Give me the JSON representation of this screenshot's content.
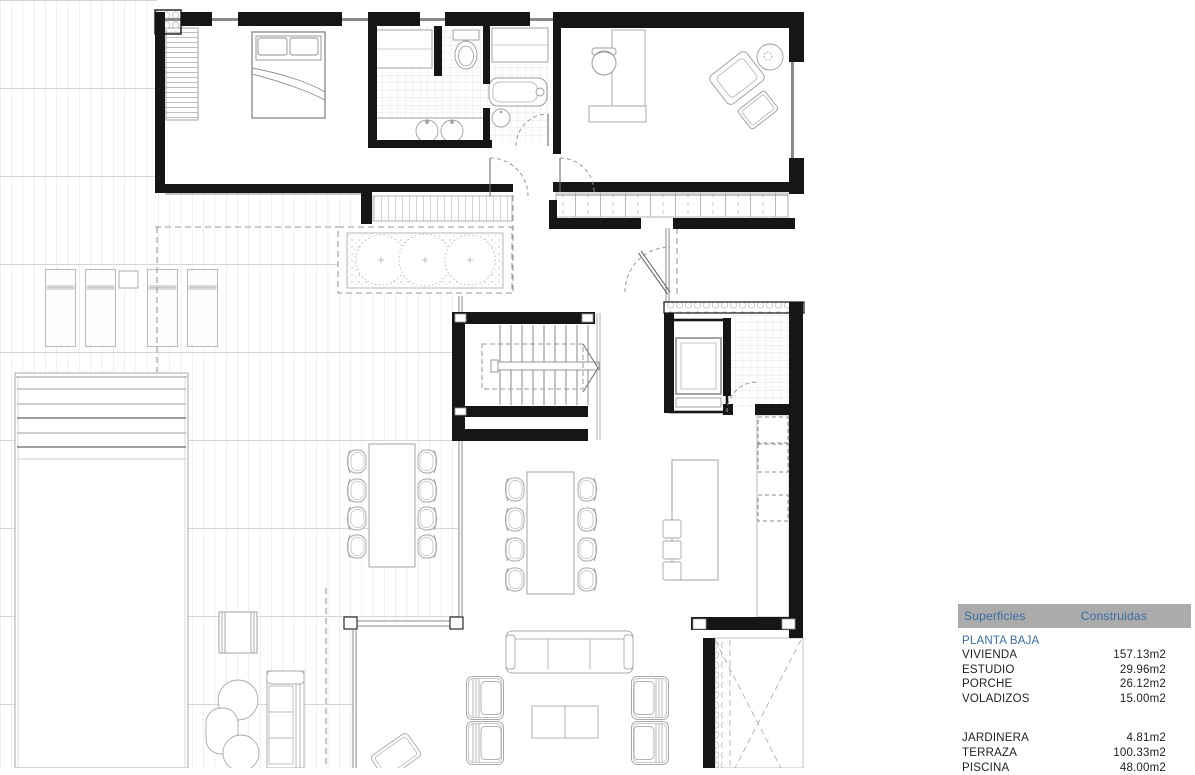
{
  "theme": {
    "header-bg": "#ababab",
    "accent-blue": "#3b6ea0",
    "row-text": "#1f1f1f",
    "page-bg": "#ffffff"
  },
  "plan_colors": {
    "wall": "#161616",
    "furniture_line": "#a0a0a0",
    "deck_grid": "#dedede",
    "dashed_overhang": "#9a9a9a"
  },
  "surfaces_table": {
    "columns": [
      "Superficies",
      "Construidas"
    ],
    "section": "PLANTA BAJA",
    "groups": [
      {
        "rows": [
          {
            "label": "VIVIENDA",
            "value": "157.13m2"
          },
          {
            "label": "ESTUDIO",
            "value": "29.96m2"
          },
          {
            "label": "PORCHE",
            "value": "26.12m2"
          },
          {
            "label": "VOLADIZOS",
            "value": "15.00m2"
          }
        ]
      },
      {
        "rows": [
          {
            "label": "JARDINERA",
            "value": "4.81m2"
          },
          {
            "label": "TERRAZA",
            "value": "100.33m2"
          },
          {
            "label": "PISCINA",
            "value": "48.00m2"
          }
        ]
      }
    ]
  }
}
